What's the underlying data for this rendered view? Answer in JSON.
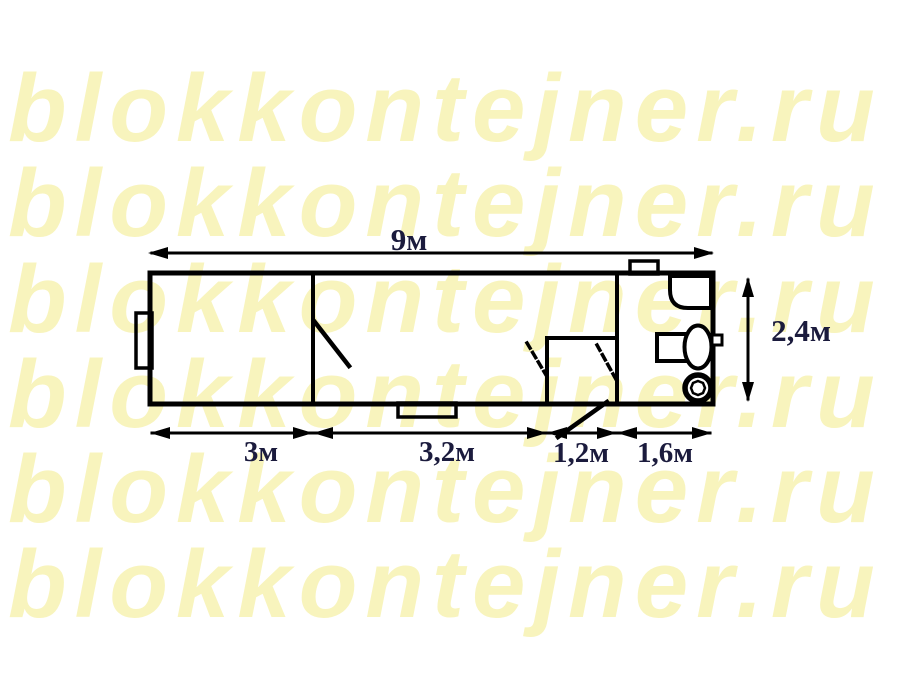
{
  "watermark": {
    "text": "blokkontejner.ru",
    "rows": 6,
    "color": "#f8f4bd"
  },
  "plan": {
    "type": "floor-plan",
    "subject": "block-container layout drawing",
    "features": [
      "container-outline",
      "partition-wall-left",
      "partition-wall-right",
      "vestibule-walls",
      "door-leaf-room1",
      "door-swing-vestibule-left",
      "door-swing-vestibule-right",
      "entry-door-leaf",
      "window-left-wall",
      "window-bottom-wall",
      "roof-vent",
      "corner-sink",
      "cistern",
      "wash-basin",
      "floor-drain"
    ]
  },
  "dimensions": {
    "total_length": "9м",
    "height": "2,4м",
    "segments": [
      "3м",
      "3,2м",
      "1,2м",
      "1,6м"
    ]
  },
  "colors": {
    "background": "#ffffff",
    "line": "#000000",
    "dimension_text": "#1b1b3d",
    "watermark": "#f8f4bd"
  }
}
